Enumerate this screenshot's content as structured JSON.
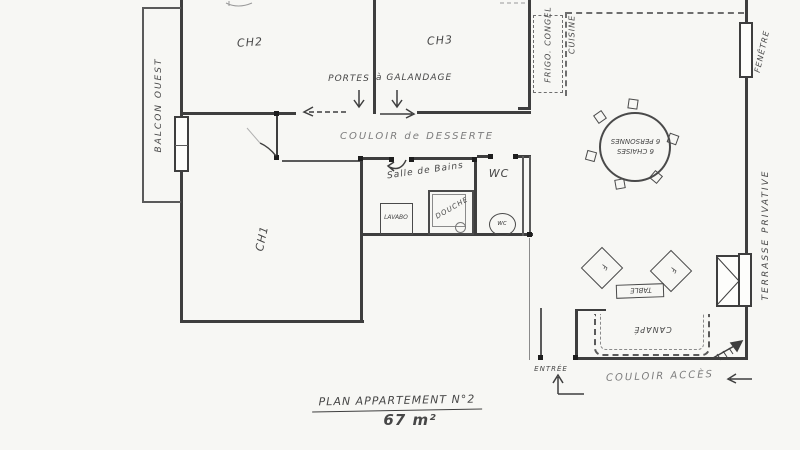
{
  "title": {
    "name": "PLAN APPARTEMENT N°2",
    "area": "67 m²"
  },
  "rooms": {
    "ch2": "CH2",
    "ch3": "CH3",
    "ch1": "CH1",
    "corridor": "COULOIR de DESSERTE",
    "bathroom": "Salle de Bains",
    "wc": "WC",
    "balcony": "BALCON OUEST",
    "access_corridor": "COULOIR ACCÈS",
    "entrance": "ENTRÉE"
  },
  "kitchen": {
    "fridge_line1": "FRIGO.",
    "fridge_line2": "CONGEL",
    "label": "CUISINE"
  },
  "openings": {
    "window_right": "FENÊTRE",
    "terrace": "TERRASSE PRIVATIVE",
    "doors_note_1": "PORTES",
    "doors_note_2": "à GALANDAGE"
  },
  "bathroom_fixtures": {
    "sink": "LAVABO",
    "shower": "DOUCHE",
    "toilet": "wc"
  },
  "furniture": {
    "dining_l1": "6 CHAISES",
    "dining_l2": "6 PERSONNES",
    "armchair": "F",
    "coffee_table": "TABLE",
    "sofa": "CANAPÉ"
  }
}
